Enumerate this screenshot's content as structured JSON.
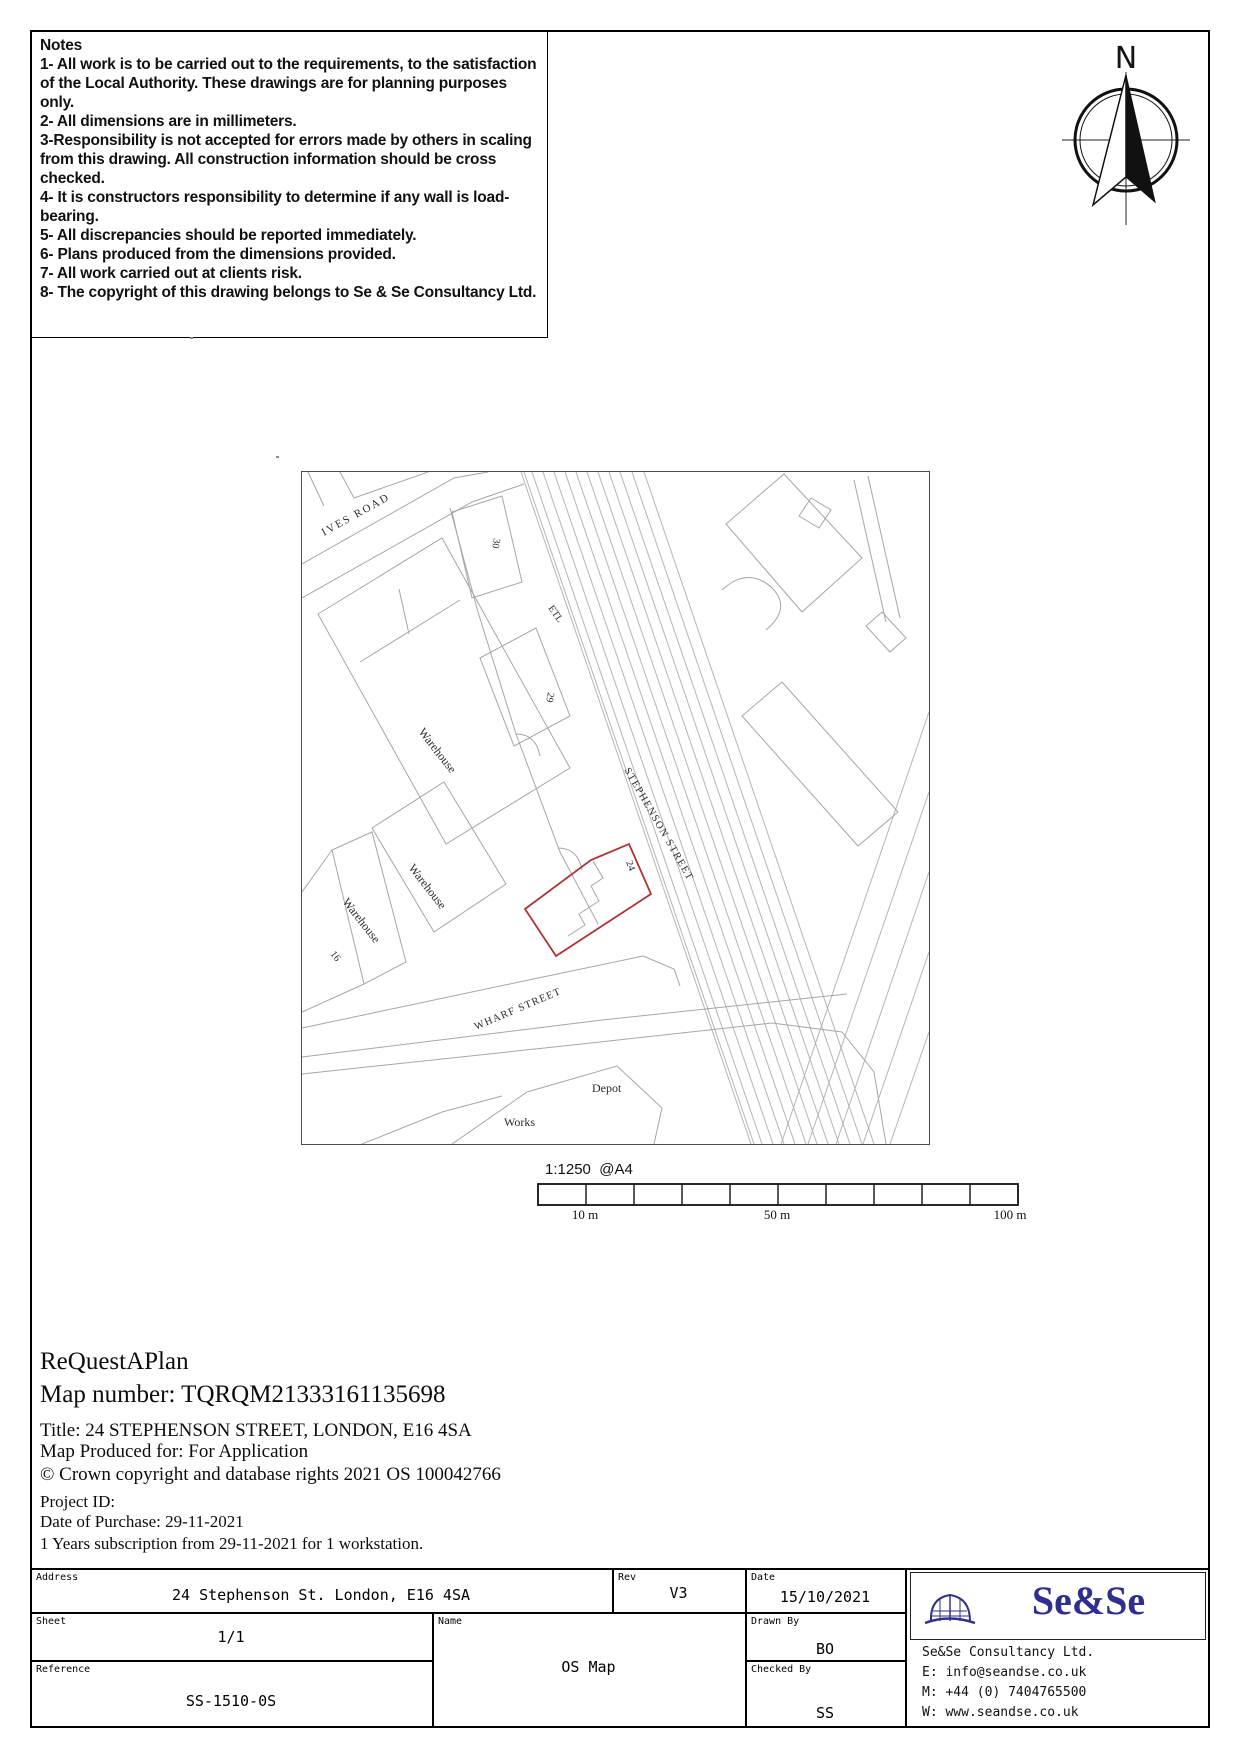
{
  "notes": {
    "title": "Notes",
    "items": [
      "1- All work is to be carried out to the requirements, to the satisfaction of the Local Authority. These drawings are for planning purposes only.",
      "2- All dimensions are in millimeters.",
      "3-Responsibility is not accepted for errors made by others in scaling from this drawing.  All construction information should be cross checked.",
      "4- It is constructors responsibility to determine if any wall is load-bearing.",
      "5- All discrepancies should be reported immediately.",
      "6- Plans produced from the dimensions provided.",
      "7- All work carried out at clients risk.",
      "8- The copyright of this drawing belongs to Se & Se Consultancy Ltd."
    ]
  },
  "compass": {
    "north_label": "N"
  },
  "map": {
    "street_labels": {
      "ives_road": "IVES ROAD",
      "stephenson_street": "STEPHENSON STREET",
      "wharf_street": "WHARF STREET"
    },
    "building_labels": {
      "warehouse_1": "Warehouse",
      "warehouse_2": "Warehouse",
      "warehouse_3": "Warehouse",
      "depot": "Depot",
      "works": "Works",
      "etl": "ETL"
    },
    "numbers": {
      "n30": "30",
      "n29": "29",
      "n24": "24",
      "n16": "16"
    },
    "plot_outline_color": "#b23232",
    "line_color": "#a6a6a6"
  },
  "scale": {
    "ratio": "1:1250",
    "paper": "@A4",
    "segments": 10,
    "ticks": [
      "10 m",
      "50 m",
      "100 m"
    ]
  },
  "info": {
    "brand": "ReQuestAPlan",
    "map_number_line": "Map number: TQRQM21333161135698",
    "title_line": "Title: 24 STEPHENSON STREET, LONDON, E16 4SA",
    "produced_line": "Map Produced for: For Application",
    "copyright_line": "© Crown copyright and database rights 2021 OS 100042766",
    "project_id_line": "Project ID:",
    "purchase_line": "Date of Purchase: 29-11-2021",
    "subscription_line": "1 Years subscription from 29-11-2021 for 1 workstation."
  },
  "title_block": {
    "address": {
      "label": "Address",
      "value": "24 Stephenson St. London, E16 4SA"
    },
    "rev": {
      "label": "Rev",
      "value": "V3"
    },
    "date": {
      "label": "Date",
      "value": "15/10/2021"
    },
    "sheet": {
      "label": "Sheet",
      "value": "1/1"
    },
    "name": {
      "label": "Name",
      "value": "OS Map"
    },
    "drawn_by": {
      "label": "Drawn By",
      "value": "BO"
    },
    "reference": {
      "label": "Reference",
      "value": "SS-1510-0S"
    },
    "checked_by": {
      "label": "Checked By",
      "value": "SS"
    },
    "company": {
      "logo_text": "Se&Se",
      "lines": [
        "Se&Se Consultancy Ltd.",
        "E: info@seandse.co.uk",
        "M: +44 (0) 7404765500",
        "W: www.seandse.co.uk"
      ]
    }
  }
}
